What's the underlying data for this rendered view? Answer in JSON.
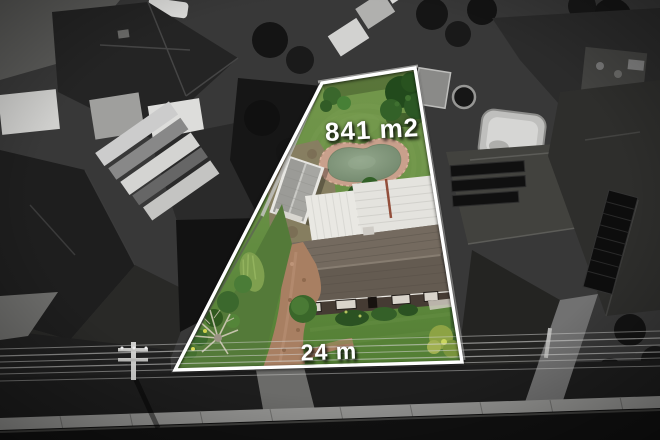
{
  "annotations": {
    "area_label": "841 m2",
    "frontage_label": "24 m"
  },
  "colors": {
    "boundary-line": "#ffffff",
    "label-text": "#ffffff",
    "pond-edge": "#c9a08c",
    "pond-water": "#7e9178",
    "driveway-brick": "#a87f62",
    "roof-main": "#6a6157",
    "roof-metal-white": "#e9e8e3",
    "grass-back": "#73974b",
    "grass-front": "#527d33",
    "surroundings": "#3a3a3a",
    "footpath": "#949492",
    "road": "#111111"
  }
}
